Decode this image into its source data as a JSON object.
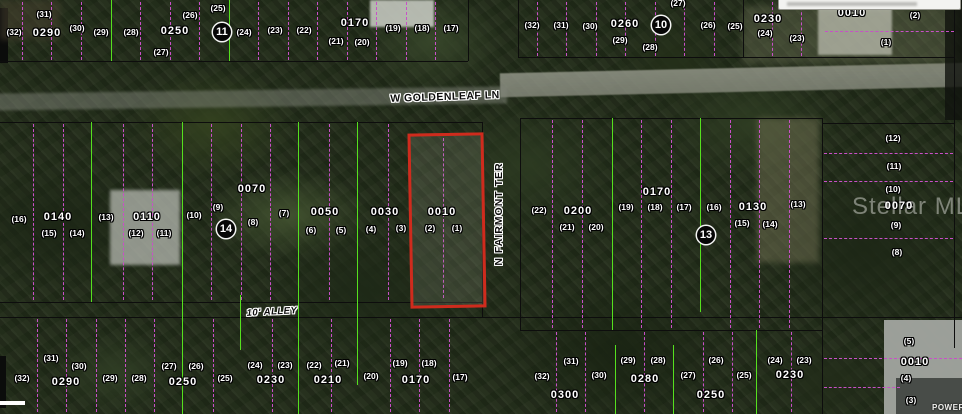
{
  "colors": {
    "black": "#0d0d0d",
    "green": "#55e01e",
    "magenta": "#c94fc8",
    "red": "#cf2b1d"
  },
  "watermark": {
    "text": "Stellar MLS"
  },
  "corner": {
    "power_label": "POWER"
  },
  "highlight_parcel": {
    "parcel_id": "0010",
    "lot_numbers": [
      "(2)",
      "(1)"
    ],
    "x": 409,
    "y": 133,
    "width": 70,
    "height": 169,
    "stroke": "#cf2b1d",
    "stroke_width": 3.5
  },
  "labels": [
    {
      "t": "sh",
      "s": "W GOLDENLEAF LN",
      "x": 445,
      "y": 97,
      "r": -2
    },
    {
      "t": "sv",
      "s": "N FAIRMONT TER",
      "x": 499,
      "y": 214
    },
    {
      "t": "sa",
      "s": "10' ALLEY",
      "x": 272,
      "y": 312,
      "r": -3
    },
    {
      "t": "l",
      "s": "(31)",
      "x": 44,
      "y": 14
    },
    {
      "t": "l",
      "s": "(32)",
      "x": 14,
      "y": 32
    },
    {
      "t": "p",
      "s": "0290",
      "x": 47,
      "y": 33
    },
    {
      "t": "l",
      "s": "(30)",
      "x": 77,
      "y": 28
    },
    {
      "t": "l",
      "s": "(29)",
      "x": 101,
      "y": 32
    },
    {
      "t": "l",
      "s": "(28)",
      "x": 131,
      "y": 32
    },
    {
      "t": "p",
      "s": "0250",
      "x": 175,
      "y": 31
    },
    {
      "t": "l",
      "s": "(27)",
      "x": 161,
      "y": 52
    },
    {
      "t": "l",
      "s": "(26)",
      "x": 190,
      "y": 15
    },
    {
      "t": "l",
      "s": "(25)",
      "x": 218,
      "y": 8
    },
    {
      "t": "b",
      "s": "11",
      "x": 222,
      "y": 32
    },
    {
      "t": "l",
      "s": "(24)",
      "x": 244,
      "y": 32
    },
    {
      "t": "l",
      "s": "(23)",
      "x": 275,
      "y": 30
    },
    {
      "t": "l",
      "s": "(22)",
      "x": 304,
      "y": 30
    },
    {
      "t": "p",
      "s": "0170",
      "x": 355,
      "y": 23
    },
    {
      "t": "l",
      "s": "(21)",
      "x": 336,
      "y": 41
    },
    {
      "t": "l",
      "s": "(20)",
      "x": 362,
      "y": 42
    },
    {
      "t": "l",
      "s": "(19)",
      "x": 393,
      "y": 28
    },
    {
      "t": "l",
      "s": "(18)",
      "x": 422,
      "y": 28
    },
    {
      "t": "l",
      "s": "(17)",
      "x": 451,
      "y": 28
    },
    {
      "t": "l",
      "s": "(32)",
      "x": 532,
      "y": 25
    },
    {
      "t": "l",
      "s": "(31)",
      "x": 561,
      "y": 25
    },
    {
      "t": "l",
      "s": "(30)",
      "x": 590,
      "y": 26
    },
    {
      "t": "p",
      "s": "0260",
      "x": 625,
      "y": 24
    },
    {
      "t": "b",
      "s": "10",
      "x": 661,
      "y": 25
    },
    {
      "t": "l",
      "s": "(29)",
      "x": 620,
      "y": 40
    },
    {
      "t": "l",
      "s": "(28)",
      "x": 650,
      "y": 47
    },
    {
      "t": "l",
      "s": "(27)",
      "x": 678,
      "y": 3
    },
    {
      "t": "l",
      "s": "(26)",
      "x": 708,
      "y": 25
    },
    {
      "t": "l",
      "s": "(25)",
      "x": 735,
      "y": 26
    },
    {
      "t": "p",
      "s": "0230",
      "x": 768,
      "y": 19
    },
    {
      "t": "l",
      "s": "(24)",
      "x": 765,
      "y": 33
    },
    {
      "t": "l",
      "s": "(23)",
      "x": 797,
      "y": 38
    },
    {
      "t": "p",
      "s": "0010",
      "x": 852,
      "y": 13
    },
    {
      "t": "l",
      "s": "(2)",
      "x": 915,
      "y": 15
    },
    {
      "t": "l",
      "s": "(1)",
      "x": 886,
      "y": 42
    },
    {
      "t": "l",
      "s": "(16)",
      "x": 19,
      "y": 219
    },
    {
      "t": "p",
      "s": "0140",
      "x": 58,
      "y": 217
    },
    {
      "t": "l",
      "s": "(15)",
      "x": 49,
      "y": 233
    },
    {
      "t": "l",
      "s": "(14)",
      "x": 77,
      "y": 233
    },
    {
      "t": "l",
      "s": "(13)",
      "x": 106,
      "y": 217
    },
    {
      "t": "p",
      "s": "0110",
      "x": 147,
      "y": 217
    },
    {
      "t": "l",
      "s": "(12)",
      "x": 136,
      "y": 233
    },
    {
      "t": "l",
      "s": "(11)",
      "x": 164,
      "y": 233
    },
    {
      "t": "l",
      "s": "(10)",
      "x": 194,
      "y": 215
    },
    {
      "t": "l",
      "s": "(9)",
      "x": 218,
      "y": 207
    },
    {
      "t": "b",
      "s": "14",
      "x": 226,
      "y": 229
    },
    {
      "t": "l",
      "s": "(8)",
      "x": 253,
      "y": 222
    },
    {
      "t": "p",
      "s": "0070",
      "x": 252,
      "y": 189
    },
    {
      "t": "l",
      "s": "(7)",
      "x": 284,
      "y": 213
    },
    {
      "t": "p",
      "s": "0050",
      "x": 325,
      "y": 212
    },
    {
      "t": "l",
      "s": "(6)",
      "x": 311,
      "y": 230
    },
    {
      "t": "l",
      "s": "(5)",
      "x": 341,
      "y": 230
    },
    {
      "t": "p",
      "s": "0030",
      "x": 385,
      "y": 212
    },
    {
      "t": "l",
      "s": "(4)",
      "x": 371,
      "y": 229
    },
    {
      "t": "l",
      "s": "(3)",
      "x": 401,
      "y": 228
    },
    {
      "t": "p",
      "s": "0010",
      "x": 442,
      "y": 212
    },
    {
      "t": "l",
      "s": "(2)",
      "x": 430,
      "y": 228
    },
    {
      "t": "l",
      "s": "(1)",
      "x": 457,
      "y": 228
    },
    {
      "t": "l",
      "s": "(22)",
      "x": 539,
      "y": 210
    },
    {
      "t": "p",
      "s": "0200",
      "x": 578,
      "y": 211
    },
    {
      "t": "l",
      "s": "(21)",
      "x": 567,
      "y": 227
    },
    {
      "t": "l",
      "s": "(20)",
      "x": 596,
      "y": 227
    },
    {
      "t": "l",
      "s": "(19)",
      "x": 626,
      "y": 207
    },
    {
      "t": "l",
      "s": "(18)",
      "x": 655,
      "y": 207
    },
    {
      "t": "p",
      "s": "0170",
      "x": 657,
      "y": 192
    },
    {
      "t": "l",
      "s": "(17)",
      "x": 684,
      "y": 207
    },
    {
      "t": "l",
      "s": "(16)",
      "x": 714,
      "y": 207
    },
    {
      "t": "p",
      "s": "0130",
      "x": 753,
      "y": 207
    },
    {
      "t": "l",
      "s": "(15)",
      "x": 742,
      "y": 223
    },
    {
      "t": "l",
      "s": "(14)",
      "x": 770,
      "y": 224
    },
    {
      "t": "b",
      "s": "13",
      "x": 706,
      "y": 235
    },
    {
      "t": "l",
      "s": "(13)",
      "x": 798,
      "y": 204
    },
    {
      "t": "l",
      "s": "(12)",
      "x": 893,
      "y": 138
    },
    {
      "t": "l",
      "s": "(11)",
      "x": 894,
      "y": 166
    },
    {
      "t": "l",
      "s": "(10)",
      "x": 893,
      "y": 189
    },
    {
      "t": "p",
      "s": "0070",
      "x": 899,
      "y": 206
    },
    {
      "t": "l",
      "s": "(9)",
      "x": 896,
      "y": 225
    },
    {
      "t": "l",
      "s": "(8)",
      "x": 897,
      "y": 252
    },
    {
      "t": "l",
      "s": "(31)",
      "x": 51,
      "y": 358
    },
    {
      "t": "l",
      "s": "(30)",
      "x": 79,
      "y": 366
    },
    {
      "t": "l",
      "s": "(32)",
      "x": 22,
      "y": 378
    },
    {
      "t": "p",
      "s": "0290",
      "x": 66,
      "y": 382
    },
    {
      "t": "l",
      "s": "(29)",
      "x": 110,
      "y": 378
    },
    {
      "t": "l",
      "s": "(28)",
      "x": 139,
      "y": 378
    },
    {
      "t": "l",
      "s": "(27)",
      "x": 169,
      "y": 366
    },
    {
      "t": "l",
      "s": "(26)",
      "x": 196,
      "y": 366
    },
    {
      "t": "p",
      "s": "0250",
      "x": 183,
      "y": 382
    },
    {
      "t": "l",
      "s": "(25)",
      "x": 225,
      "y": 378
    },
    {
      "t": "l",
      "s": "(24)",
      "x": 255,
      "y": 365
    },
    {
      "t": "l",
      "s": "(23)",
      "x": 285,
      "y": 365
    },
    {
      "t": "p",
      "s": "0230",
      "x": 271,
      "y": 380
    },
    {
      "t": "l",
      "s": "(22)",
      "x": 314,
      "y": 365
    },
    {
      "t": "l",
      "s": "(21)",
      "x": 342,
      "y": 363
    },
    {
      "t": "p",
      "s": "0210",
      "x": 328,
      "y": 380
    },
    {
      "t": "l",
      "s": "(20)",
      "x": 371,
      "y": 376
    },
    {
      "t": "l",
      "s": "(19)",
      "x": 400,
      "y": 363
    },
    {
      "t": "l",
      "s": "(18)",
      "x": 429,
      "y": 363
    },
    {
      "t": "p",
      "s": "0170",
      "x": 416,
      "y": 380
    },
    {
      "t": "l",
      "s": "(17)",
      "x": 460,
      "y": 377
    },
    {
      "t": "l",
      "s": "(31)",
      "x": 571,
      "y": 361
    },
    {
      "t": "l",
      "s": "(32)",
      "x": 542,
      "y": 376
    },
    {
      "t": "l",
      "s": "(30)",
      "x": 599,
      "y": 375
    },
    {
      "t": "p",
      "s": "0300",
      "x": 565,
      "y": 395
    },
    {
      "t": "l",
      "s": "(29)",
      "x": 628,
      "y": 360
    },
    {
      "t": "l",
      "s": "(28)",
      "x": 658,
      "y": 360
    },
    {
      "t": "p",
      "s": "0280",
      "x": 645,
      "y": 379
    },
    {
      "t": "l",
      "s": "(27)",
      "x": 688,
      "y": 375
    },
    {
      "t": "l",
      "s": "(26)",
      "x": 716,
      "y": 360
    },
    {
      "t": "l",
      "s": "(25)",
      "x": 744,
      "y": 375
    },
    {
      "t": "p",
      "s": "0250",
      "x": 711,
      "y": 395
    },
    {
      "t": "l",
      "s": "(24)",
      "x": 775,
      "y": 360
    },
    {
      "t": "l",
      "s": "(23)",
      "x": 804,
      "y": 360
    },
    {
      "t": "p",
      "s": "0230",
      "x": 790,
      "y": 375
    },
    {
      "t": "l",
      "s": "(5)",
      "x": 909,
      "y": 341
    },
    {
      "t": "p",
      "s": "0010",
      "x": 915,
      "y": 362
    },
    {
      "t": "l",
      "s": "(4)",
      "x": 906,
      "y": 378
    },
    {
      "t": "l",
      "s": "(3)",
      "x": 911,
      "y": 400
    }
  ],
  "lines": [
    {
      "o": "h",
      "p": 61,
      "a": 0,
      "b": 468,
      "c": "black"
    },
    {
      "o": "h",
      "p": 57,
      "a": 518,
      "b": 954,
      "c": "black"
    },
    {
      "o": "h",
      "p": 122,
      "a": 0,
      "b": 482,
      "c": "black"
    },
    {
      "o": "h",
      "p": 118,
      "a": 520,
      "b": 822,
      "c": "black"
    },
    {
      "o": "h",
      "p": 302,
      "a": 0,
      "b": 482,
      "c": "black"
    },
    {
      "o": "h",
      "p": 317,
      "a": 0,
      "b": 962,
      "c": "black"
    },
    {
      "o": "h",
      "p": 330,
      "a": 520,
      "b": 822,
      "c": "black"
    },
    {
      "o": "h",
      "p": 123,
      "a": 822,
      "b": 954,
      "c": "black"
    },
    {
      "o": "v",
      "p": 468,
      "a": 0,
      "b": 61,
      "c": "black"
    },
    {
      "o": "v",
      "p": 518,
      "a": 0,
      "b": 57,
      "c": "black"
    },
    {
      "o": "v",
      "p": 482,
      "a": 122,
      "b": 317,
      "c": "black"
    },
    {
      "o": "v",
      "p": 520,
      "a": 118,
      "b": 330,
      "c": "black"
    },
    {
      "o": "v",
      "p": 743,
      "a": 0,
      "b": 57,
      "c": "black"
    },
    {
      "o": "v",
      "p": 822,
      "a": 118,
      "b": 414,
      "c": "black"
    },
    {
      "o": "v",
      "p": 954,
      "a": 0,
      "b": 348,
      "c": "black"
    },
    {
      "o": "v",
      "p": 111,
      "a": 0,
      "b": 61,
      "c": "green"
    },
    {
      "o": "v",
      "p": 229,
      "a": 0,
      "b": 61,
      "c": "green"
    },
    {
      "o": "v",
      "p": 91,
      "a": 122,
      "b": 302,
      "c": "green"
    },
    {
      "o": "v",
      "p": 182,
      "a": 122,
      "b": 414,
      "c": "green"
    },
    {
      "o": "v",
      "p": 240,
      "a": 295,
      "b": 350,
      "c": "green"
    },
    {
      "o": "v",
      "p": 298,
      "a": 122,
      "b": 414,
      "c": "green"
    },
    {
      "o": "v",
      "p": 357,
      "a": 122,
      "b": 385,
      "c": "green"
    },
    {
      "o": "v",
      "p": 612,
      "a": 118,
      "b": 330,
      "c": "green"
    },
    {
      "o": "v",
      "p": 700,
      "a": 118,
      "b": 312,
      "c": "green"
    },
    {
      "o": "v",
      "p": 615,
      "a": 345,
      "b": 414,
      "c": "green"
    },
    {
      "o": "v",
      "p": 673,
      "a": 345,
      "b": 414,
      "c": "green"
    },
    {
      "o": "v",
      "p": 756,
      "a": 330,
      "b": 414,
      "c": "green"
    },
    {
      "o": "v",
      "p": 22,
      "a": 2,
      "b": 60,
      "c": "magenta",
      "d": true
    },
    {
      "o": "v",
      "p": 51,
      "a": 2,
      "b": 60,
      "c": "magenta",
      "d": true
    },
    {
      "o": "v",
      "p": 81,
      "a": 2,
      "b": 60,
      "c": "magenta",
      "d": true
    },
    {
      "o": "v",
      "p": 140,
      "a": 2,
      "b": 60,
      "c": "magenta",
      "d": true
    },
    {
      "o": "v",
      "p": 170,
      "a": 2,
      "b": 60,
      "c": "magenta",
      "d": true
    },
    {
      "o": "v",
      "p": 199,
      "a": 2,
      "b": 60,
      "c": "magenta",
      "d": true
    },
    {
      "o": "v",
      "p": 258,
      "a": 2,
      "b": 60,
      "c": "magenta",
      "d": true
    },
    {
      "o": "v",
      "p": 288,
      "a": 2,
      "b": 60,
      "c": "magenta",
      "d": true
    },
    {
      "o": "v",
      "p": 317,
      "a": 2,
      "b": 60,
      "c": "magenta",
      "d": true
    },
    {
      "o": "v",
      "p": 347,
      "a": 2,
      "b": 60,
      "c": "magenta",
      "d": true
    },
    {
      "o": "v",
      "p": 376,
      "a": 2,
      "b": 60,
      "c": "magenta",
      "d": true
    },
    {
      "o": "v",
      "p": 406,
      "a": 2,
      "b": 60,
      "c": "magenta",
      "d": true
    },
    {
      "o": "v",
      "p": 435,
      "a": 2,
      "b": 60,
      "c": "magenta",
      "d": true
    },
    {
      "o": "v",
      "p": 537,
      "a": 2,
      "b": 56,
      "c": "magenta",
      "d": true
    },
    {
      "o": "v",
      "p": 566,
      "a": 2,
      "b": 56,
      "c": "magenta",
      "d": true
    },
    {
      "o": "v",
      "p": 596,
      "a": 2,
      "b": 56,
      "c": "magenta",
      "d": true
    },
    {
      "o": "v",
      "p": 625,
      "a": 2,
      "b": 56,
      "c": "magenta",
      "d": true
    },
    {
      "o": "v",
      "p": 655,
      "a": 2,
      "b": 56,
      "c": "magenta",
      "d": true
    },
    {
      "o": "v",
      "p": 684,
      "a": 2,
      "b": 56,
      "c": "magenta",
      "d": true
    },
    {
      "o": "v",
      "p": 714,
      "a": 2,
      "b": 56,
      "c": "magenta",
      "d": true
    },
    {
      "o": "v",
      "p": 772,
      "a": 2,
      "b": 56,
      "c": "magenta",
      "d": true
    },
    {
      "o": "v",
      "p": 801,
      "a": 2,
      "b": 56,
      "c": "magenta",
      "d": true
    },
    {
      "o": "h",
      "p": 31,
      "a": 825,
      "b": 954,
      "c": "magenta",
      "d": true
    },
    {
      "o": "v",
      "p": 33,
      "a": 124,
      "b": 300,
      "c": "magenta",
      "d": true
    },
    {
      "o": "v",
      "p": 63,
      "a": 124,
      "b": 300,
      "c": "magenta",
      "d": true
    },
    {
      "o": "v",
      "p": 123,
      "a": 124,
      "b": 300,
      "c": "magenta",
      "d": true
    },
    {
      "o": "v",
      "p": 152,
      "a": 124,
      "b": 300,
      "c": "magenta",
      "d": true
    },
    {
      "o": "v",
      "p": 211,
      "a": 124,
      "b": 300,
      "c": "magenta",
      "d": true
    },
    {
      "o": "v",
      "p": 241,
      "a": 124,
      "b": 300,
      "c": "magenta",
      "d": true
    },
    {
      "o": "v",
      "p": 270,
      "a": 124,
      "b": 300,
      "c": "magenta",
      "d": true
    },
    {
      "o": "v",
      "p": 329,
      "a": 124,
      "b": 300,
      "c": "magenta",
      "d": true
    },
    {
      "o": "v",
      "p": 388,
      "a": 124,
      "b": 300,
      "c": "magenta",
      "d": true
    },
    {
      "o": "v",
      "p": 443,
      "a": 138,
      "b": 298,
      "c": "magenta",
      "d": true
    },
    {
      "o": "v",
      "p": 552,
      "a": 120,
      "b": 328,
      "c": "magenta",
      "d": true
    },
    {
      "o": "v",
      "p": 582,
      "a": 120,
      "b": 328,
      "c": "magenta",
      "d": true
    },
    {
      "o": "v",
      "p": 641,
      "a": 120,
      "b": 328,
      "c": "magenta",
      "d": true
    },
    {
      "o": "v",
      "p": 671,
      "a": 120,
      "b": 328,
      "c": "magenta",
      "d": true
    },
    {
      "o": "v",
      "p": 730,
      "a": 120,
      "b": 328,
      "c": "magenta",
      "d": true
    },
    {
      "o": "v",
      "p": 759,
      "a": 120,
      "b": 328,
      "c": "magenta",
      "d": true
    },
    {
      "o": "v",
      "p": 789,
      "a": 120,
      "b": 328,
      "c": "magenta",
      "d": true
    },
    {
      "o": "h",
      "p": 153,
      "a": 824,
      "b": 953,
      "c": "magenta",
      "d": true
    },
    {
      "o": "h",
      "p": 181,
      "a": 824,
      "b": 953,
      "c": "magenta",
      "d": true
    },
    {
      "o": "h",
      "p": 238,
      "a": 824,
      "b": 953,
      "c": "magenta",
      "d": true
    },
    {
      "o": "v",
      "p": 37,
      "a": 319,
      "b": 412,
      "c": "magenta",
      "d": true
    },
    {
      "o": "v",
      "p": 66,
      "a": 319,
      "b": 412,
      "c": "magenta",
      "d": true
    },
    {
      "o": "v",
      "p": 96,
      "a": 319,
      "b": 412,
      "c": "magenta",
      "d": true
    },
    {
      "o": "v",
      "p": 125,
      "a": 319,
      "b": 412,
      "c": "magenta",
      "d": true
    },
    {
      "o": "v",
      "p": 154,
      "a": 319,
      "b": 412,
      "c": "magenta",
      "d": true
    },
    {
      "o": "v",
      "p": 213,
      "a": 319,
      "b": 412,
      "c": "magenta",
      "d": true
    },
    {
      "o": "v",
      "p": 272,
      "a": 319,
      "b": 412,
      "c": "magenta",
      "d": true
    },
    {
      "o": "v",
      "p": 331,
      "a": 319,
      "b": 412,
      "c": "magenta",
      "d": true
    },
    {
      "o": "v",
      "p": 390,
      "a": 319,
      "b": 412,
      "c": "magenta",
      "d": true
    },
    {
      "o": "v",
      "p": 419,
      "a": 319,
      "b": 412,
      "c": "magenta",
      "d": true
    },
    {
      "o": "v",
      "p": 449,
      "a": 319,
      "b": 412,
      "c": "magenta",
      "d": true
    },
    {
      "o": "v",
      "p": 556,
      "a": 332,
      "b": 412,
      "c": "magenta",
      "d": true
    },
    {
      "o": "v",
      "p": 585,
      "a": 332,
      "b": 412,
      "c": "magenta",
      "d": true
    },
    {
      "o": "v",
      "p": 644,
      "a": 332,
      "b": 412,
      "c": "magenta",
      "d": true
    },
    {
      "o": "v",
      "p": 703,
      "a": 332,
      "b": 412,
      "c": "magenta",
      "d": true
    },
    {
      "o": "v",
      "p": 732,
      "a": 332,
      "b": 412,
      "c": "magenta",
      "d": true
    },
    {
      "o": "v",
      "p": 791,
      "a": 332,
      "b": 412,
      "c": "magenta",
      "d": true
    },
    {
      "o": "h",
      "p": 358,
      "a": 824,
      "b": 962,
      "c": "magenta",
      "d": true
    },
    {
      "o": "h",
      "p": 387,
      "a": 824,
      "b": 900,
      "c": "magenta",
      "d": true
    }
  ]
}
